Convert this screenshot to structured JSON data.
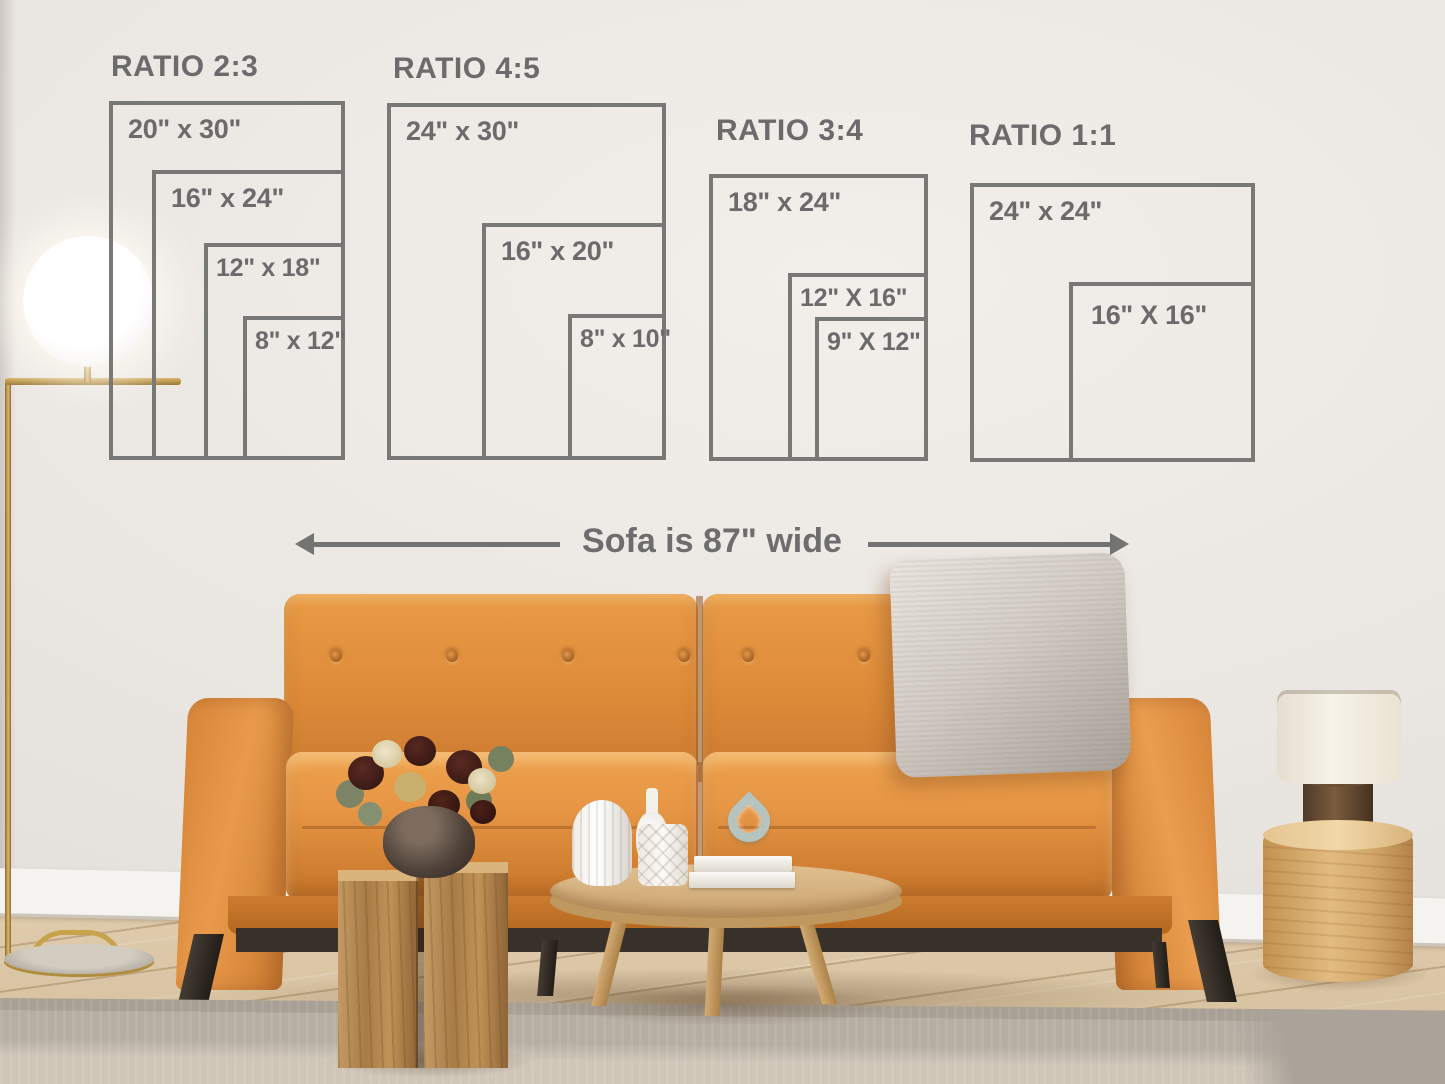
{
  "annotation": {
    "sofa_width": "Sofa is 87\" wide"
  },
  "ratio_groups": [
    {
      "title": "RATIO 2:3",
      "sizes": [
        "20\" x 30\"",
        "16\" x 24\"",
        "12\" x 18\"",
        "8\" x 12\""
      ]
    },
    {
      "title": "RATIO 4:5",
      "sizes": [
        "24\" x 30\"",
        "16\" x 20\"",
        "8\" x 10\""
      ]
    },
    {
      "title": "RATIO 3:4",
      "sizes": [
        "18\" x 24\"",
        "12\" X 16\"",
        "9\" X 12\""
      ]
    },
    {
      "title": "RATIO 1:1",
      "sizes": [
        "24\" x 24\"",
        "16\" X 16\""
      ]
    }
  ],
  "colors": {
    "diagram_line": "#787876",
    "diagram_text": "#6b6b6b",
    "wall": "#ece8e4",
    "sofa_leather": "#dd8a38",
    "pillow_gray": "#cfc9c2",
    "wood_floor": "#d9c4a4",
    "rug": "#cfc6b8"
  }
}
